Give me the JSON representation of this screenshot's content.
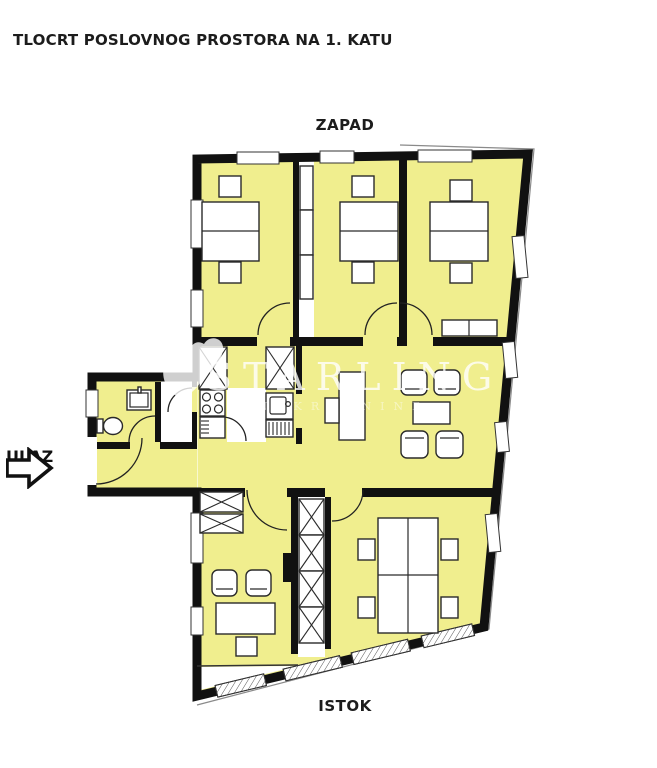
{
  "page": {
    "background": "#ffffff"
  },
  "title": {
    "text": "TLOCRT POSLOVNOG PROSTORA NA 1. KATU"
  },
  "compass": {
    "west_label": "ZAPAD",
    "east_label": "ISTOK"
  },
  "entrance": {
    "label": "ULAZ",
    "arrow_icon": "right-arrow"
  },
  "watermark": {
    "brand": "STARLING",
    "tagline": "NEKRETNINE",
    "logo": "bird-icon"
  },
  "floor_plan": {
    "room_fill": "#f0ee8e",
    "wall_color": "#111111",
    "furniture_outline": "#2a2a2a",
    "furniture_fill": "#ffffff"
  }
}
